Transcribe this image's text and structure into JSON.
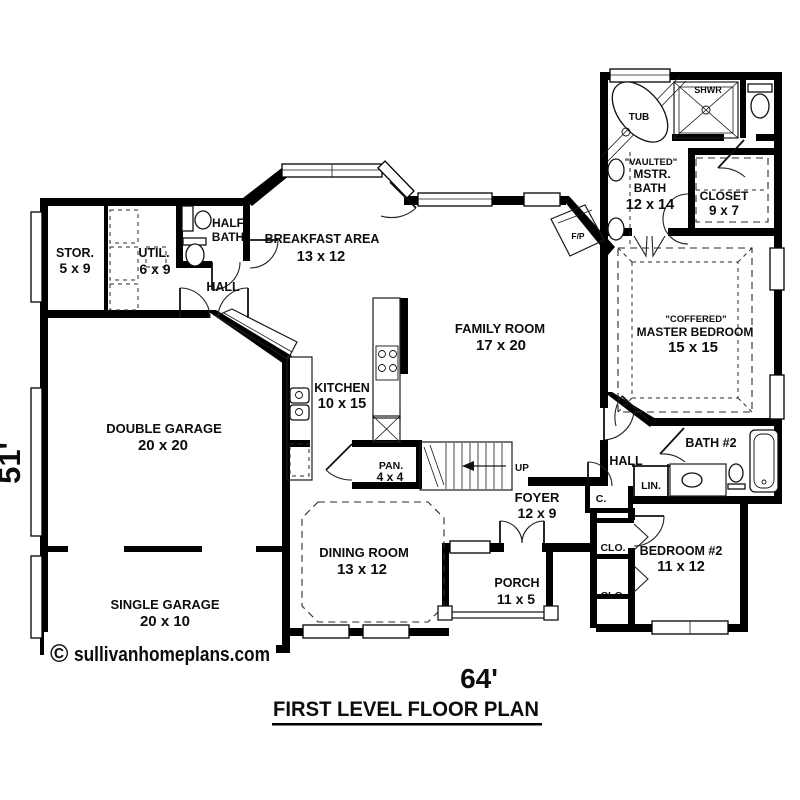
{
  "title": {
    "text": "FIRST LEVEL FLOOR PLAN"
  },
  "dimensions": {
    "width": "64'",
    "height": "51'"
  },
  "watermark": {
    "symbol": "©",
    "text": "sullivanhomeplans.com"
  },
  "rooms": {
    "stor": {
      "name": "STOR.",
      "dims": "5 x 9"
    },
    "util": {
      "name": "UTIL.",
      "dims": "6 x 9"
    },
    "half_bath": {
      "name_line1": "HALF",
      "name_line2": "BATH"
    },
    "hall_left": {
      "name": "HALL"
    },
    "breakfast": {
      "name": "BREAKFAST AREA",
      "dims": "13 x 12"
    },
    "kitchen": {
      "name": "KITCHEN",
      "dims": "10 x 15"
    },
    "pantry": {
      "name": "PAN.",
      "dims": "4 x 4"
    },
    "double_garage": {
      "name": "DOUBLE GARAGE",
      "dims": "20 x 20"
    },
    "single_garage": {
      "name": "SINGLE GARAGE",
      "dims": "20 x 10"
    },
    "dining_room": {
      "name": "DINING ROOM",
      "dims": "13 x 12"
    },
    "family_room": {
      "name": "FAMILY ROOM",
      "dims": "17 x 20"
    },
    "foyer": {
      "name": "FOYER",
      "dims": "12 x 9"
    },
    "porch": {
      "name": "PORCH",
      "dims": "11 x 5"
    },
    "master_bath": {
      "qualifier": "\"VAULTED\"",
      "name_line1": "MSTR.",
      "name_line2": "BATH",
      "dims": "12 x 14"
    },
    "master_closet": {
      "name": "CLOSET",
      "dims": "9 x 7"
    },
    "master_bedroom": {
      "qualifier": "\"COFFERED\"",
      "name": "MASTER BEDROOM",
      "dims": "15 x 15"
    },
    "bath2": {
      "name": "BATH #2"
    },
    "hall_right": {
      "name": "HALL"
    },
    "linen": {
      "name": "LIN."
    },
    "closet_c": {
      "name": "C."
    },
    "closet_upper": {
      "name": "CLO."
    },
    "closet_lower": {
      "name": "CLO."
    },
    "bedroom2": {
      "name": "BEDROOM #2",
      "dims": "11 x 12"
    }
  },
  "fixtures": {
    "tub": "TUB",
    "shower": "SHWR",
    "fireplace": "F/P",
    "stairs": "UP"
  },
  "colors": {
    "wall": "#000000",
    "background": "#ffffff",
    "line": "#1a1a1a"
  }
}
